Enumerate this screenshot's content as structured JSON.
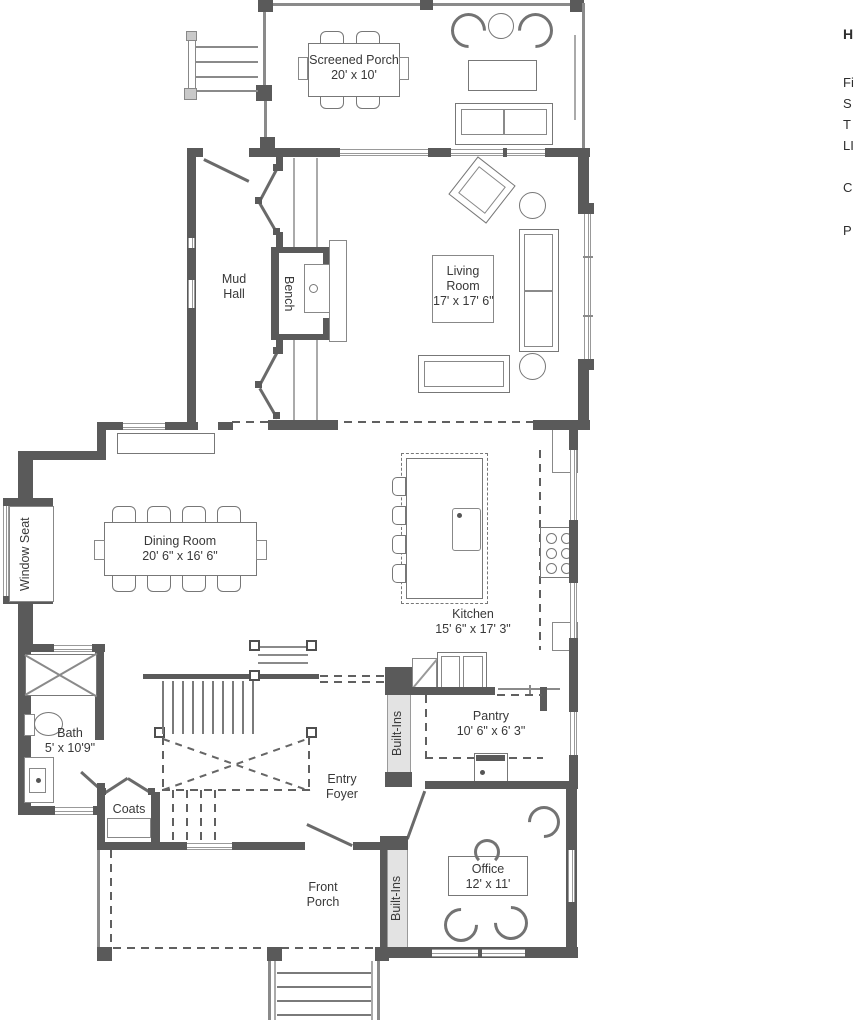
{
  "colors": {
    "wall": "#5a5a5a",
    "line": "#7a7a7a",
    "text": "#383838"
  },
  "legend": {
    "heading": "H",
    "items": [
      "Fi",
      "S",
      "T",
      "LI",
      "C",
      "P"
    ]
  },
  "rooms": {
    "screened_porch": {
      "name": "Screened Porch",
      "dims": "20' x 10'"
    },
    "living_room": {
      "name": "Living Room",
      "dims": "17' x 17' 6\""
    },
    "mud_hall": {
      "name": "Mud Hall"
    },
    "bench": {
      "name": "Bench"
    },
    "dining_room": {
      "name": "Dining Room",
      "dims": "20' 6\" x 16' 6\""
    },
    "window_seat": {
      "name": "Window Seat"
    },
    "kitchen": {
      "name": "Kitchen",
      "dims": "15' 6\" x 17' 3\""
    },
    "bath": {
      "name": "Bath",
      "dims": "5' x 10'9\""
    },
    "coats": {
      "name": "Coats"
    },
    "entry_foyer": {
      "name": "Entry Foyer"
    },
    "built_ins_hall": {
      "name": "Built-Ins"
    },
    "pantry": {
      "name": "Pantry",
      "dims": "10' 6\" x 6' 3\""
    },
    "built_ins_office": {
      "name": "Built-Ins"
    },
    "office": {
      "name": "Office",
      "dims": "12' x 11'"
    },
    "front_porch": {
      "name": "Front Porch"
    }
  }
}
